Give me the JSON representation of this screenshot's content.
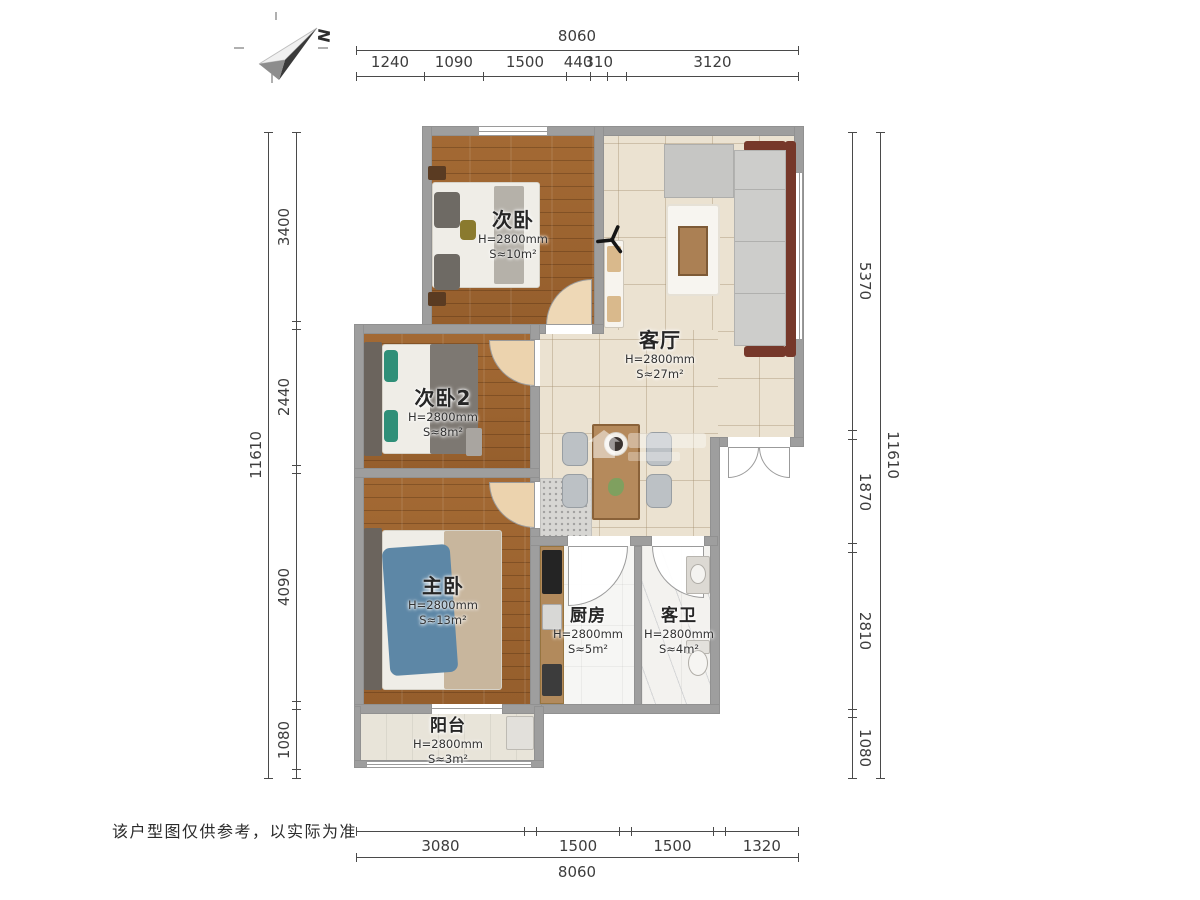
{
  "north": {
    "label": "N"
  },
  "note": "该户型图仅供参考，以实际为准",
  "rooms": [
    {
      "name": "次卧",
      "height": "H=2800mm",
      "area": "S≈10m²"
    },
    {
      "name": "客厅",
      "height": "H=2800mm",
      "area": "S≈27m²"
    },
    {
      "name": "次卧2",
      "height": "H=2800mm",
      "area": "S≈8m²"
    },
    {
      "name": "主卧",
      "height": "H=2800mm",
      "area": "S≈13m²"
    },
    {
      "name": "厨房",
      "height": "H=2800mm",
      "area": "S≈5m²"
    },
    {
      "name": "客卫",
      "height": "H=2800mm",
      "area": "S≈4m²"
    },
    {
      "name": "阳台",
      "height": "H=2800mm",
      "area": "S≈3m²"
    }
  ],
  "dimensions": {
    "top_total": {
      "orient": "h",
      "style": "above",
      "segments": [
        {
          "label": "8060",
          "mm": 8060
        }
      ]
    },
    "top_segments": {
      "orient": "h",
      "style": "above",
      "segments": [
        {
          "label": "1240",
          "mm": 1240
        },
        {
          "label": "1090",
          "mm": 1090
        },
        {
          "label": "1500",
          "mm": 1500
        },
        {
          "label": "440",
          "mm": 440
        },
        {
          "label": "310",
          "mm": 310
        },
        {
          "label": "",
          "mm": 360
        },
        {
          "label": "3120",
          "mm": 3120
        }
      ]
    },
    "bottom_segments": {
      "orient": "h",
      "style": "below",
      "segments": [
        {
          "label": "3080",
          "mm": 3080
        },
        {
          "label": "",
          "mm": 220
        },
        {
          "label": "1500",
          "mm": 1500
        },
        {
          "label": "",
          "mm": 220
        },
        {
          "label": "1500",
          "mm": 1500
        },
        {
          "label": "",
          "mm": 220
        },
        {
          "label": "1320",
          "mm": 1320
        }
      ]
    },
    "bottom_total": {
      "orient": "h",
      "style": "below",
      "segments": [
        {
          "label": "8060",
          "mm": 8060
        }
      ]
    },
    "left_total": {
      "orient": "v",
      "style": "left",
      "segments": [
        {
          "label": "11610",
          "mm": 11610
        }
      ]
    },
    "left_segments": {
      "orient": "v",
      "style": "left",
      "segments": [
        {
          "label": "3400",
          "mm": 3400
        },
        {
          "label": "",
          "mm": 150
        },
        {
          "label": "2440",
          "mm": 2440
        },
        {
          "label": "",
          "mm": 150
        },
        {
          "label": "4090",
          "mm": 4090
        },
        {
          "label": "",
          "mm": 150
        },
        {
          "label": "1080",
          "mm": 1080
        },
        {
          "label": "",
          "mm": 150
        }
      ]
    },
    "right_segments": {
      "orient": "v",
      "style": "right",
      "segments": [
        {
          "label": "5370",
          "mm": 5370
        },
        {
          "label": "",
          "mm": 160
        },
        {
          "label": "1870",
          "mm": 1870
        },
        {
          "label": "",
          "mm": 160
        },
        {
          "label": "2810",
          "mm": 2810
        },
        {
          "label": "",
          "mm": 160
        },
        {
          "label": "1080",
          "mm": 1080
        }
      ]
    },
    "right_total": {
      "orient": "v",
      "style": "right",
      "segments": [
        {
          "label": "11610",
          "mm": 11610
        }
      ]
    }
  },
  "colors": {
    "wood_floor": "#9c6431",
    "tile": "#ebe2d1",
    "wall": "#9e9e9e",
    "sofa_frame": "#76382a",
    "teal_pillow": "#2f8f78",
    "blue_bedding": "#5d87a6"
  }
}
